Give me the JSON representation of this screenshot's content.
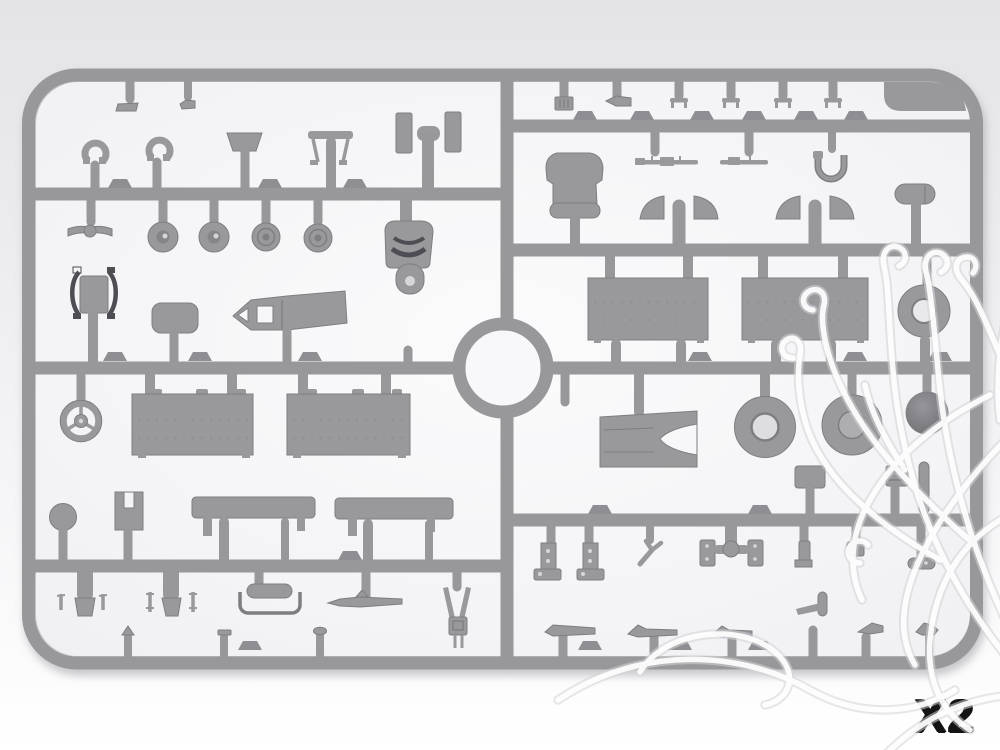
{
  "footer": {
    "quantity_label": "X2"
  },
  "colors": {
    "bg_top": "#e4e4e6",
    "bg_bottom": "#ffffff",
    "panel_center": "#fafafb",
    "panel_edge": "#f0f0f3",
    "sprue": "#98989b",
    "sprue_dark": "#85858a",
    "sprue_light": "#aeaeb1",
    "part": "#99999c",
    "part_dark": "#7e7e82",
    "part_deep": "#4e4e52",
    "hole_light": "#d7d7da",
    "shadow": "#8e8e96",
    "watermark": "#ffffff",
    "watermark_edge": "#d4d4d8",
    "label_text": "#141414"
  }
}
